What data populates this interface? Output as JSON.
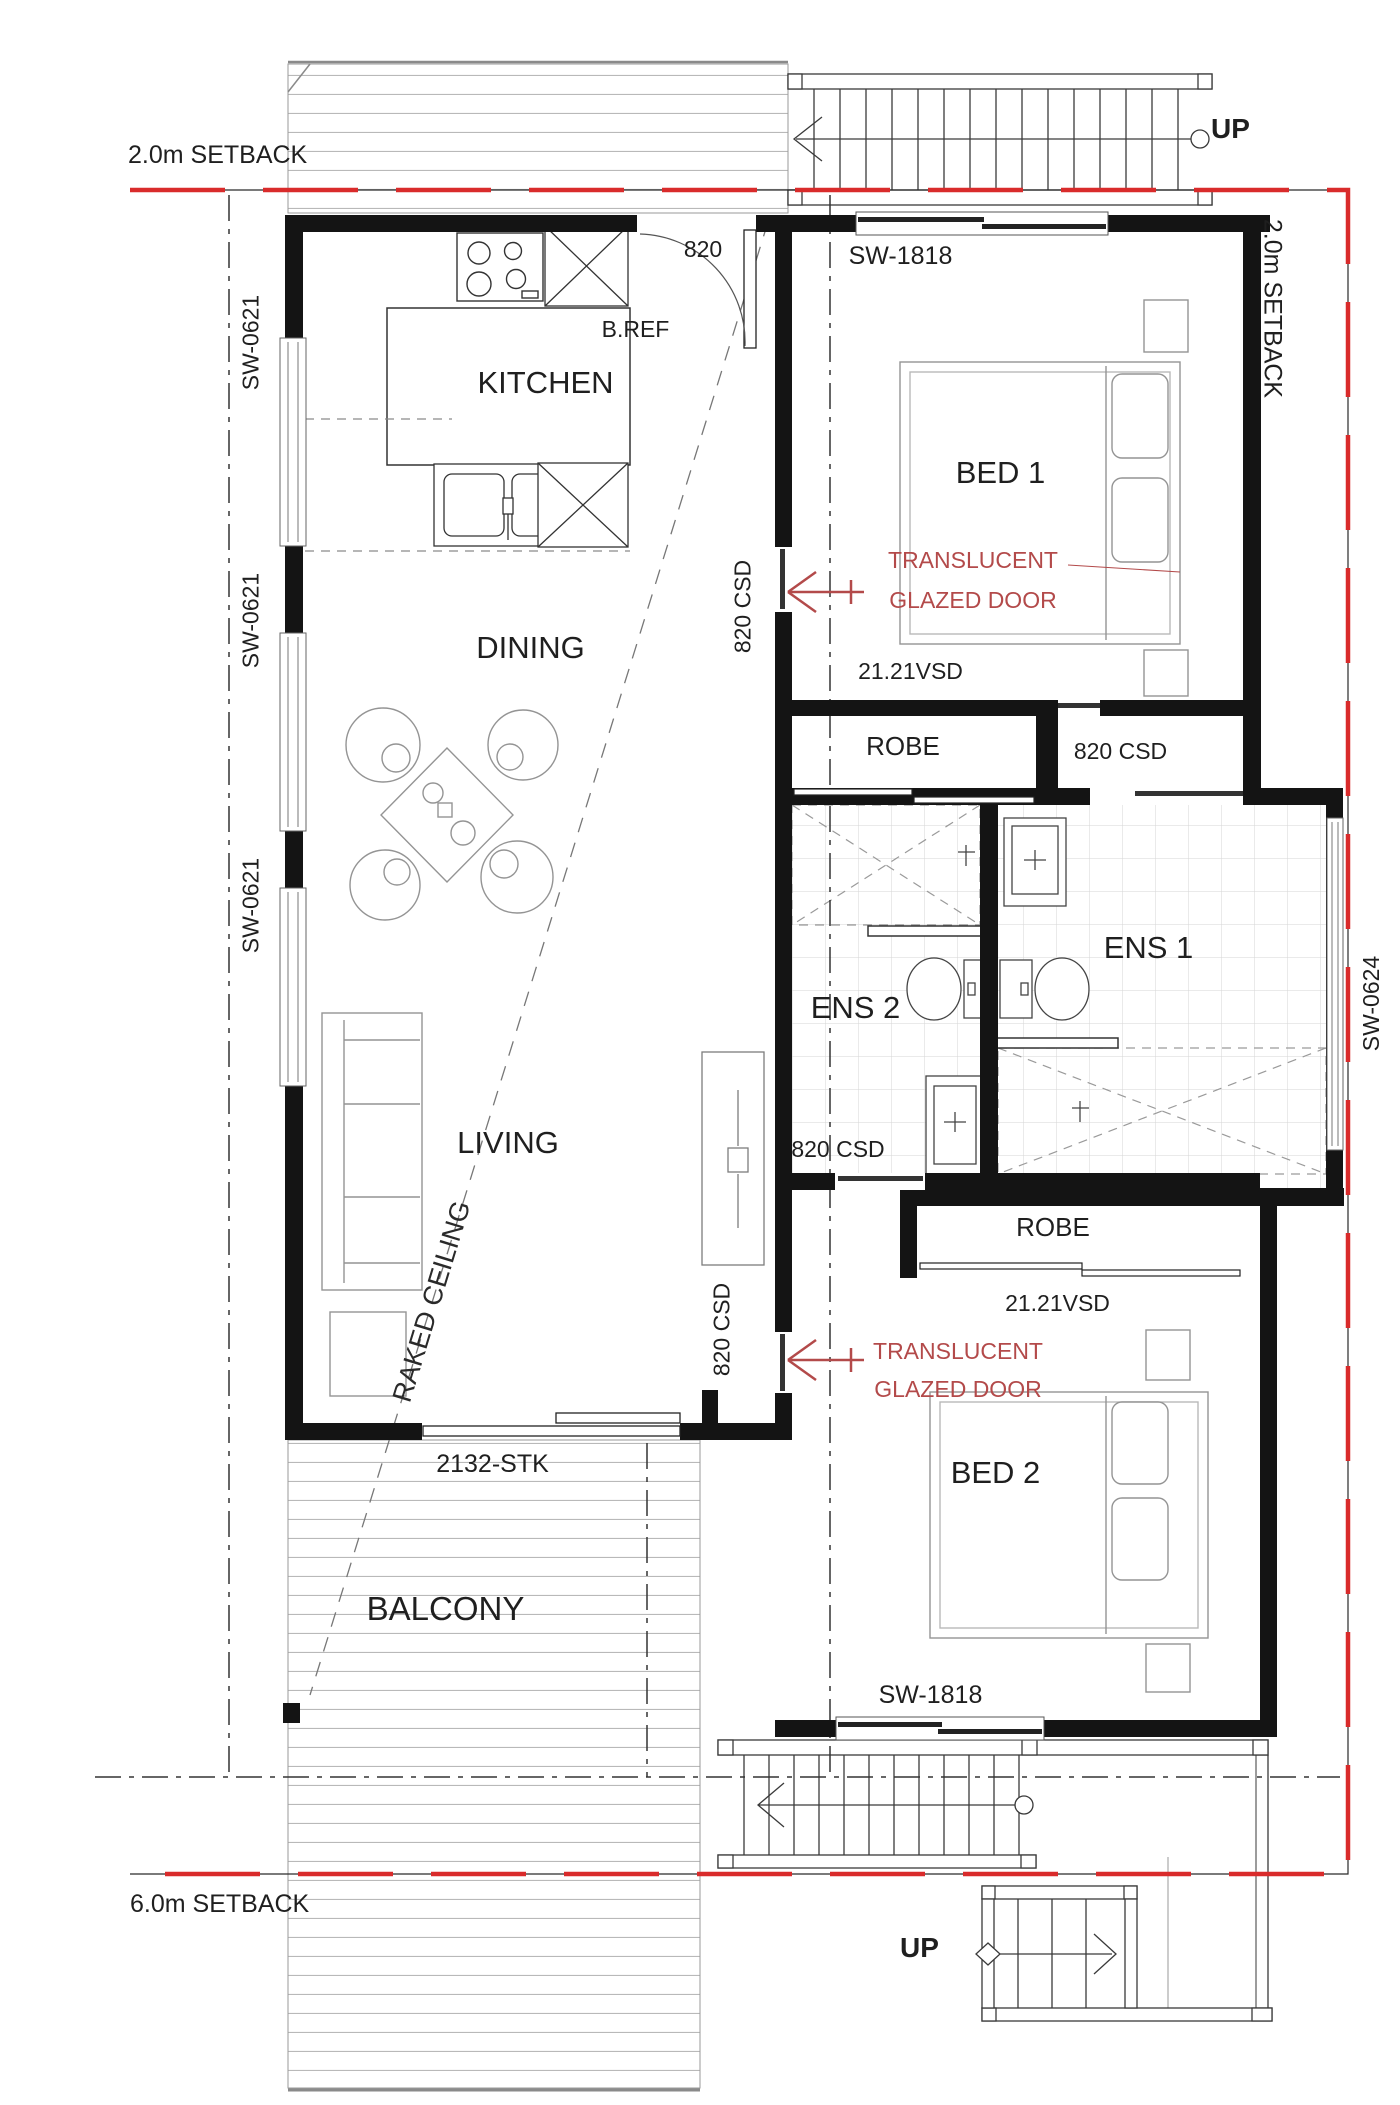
{
  "plan": {
    "setbacks": {
      "top": "2.0m SETBACK",
      "right": "2.0m SETBACK",
      "bottom": "6.0m SETBACK"
    },
    "rooms": {
      "kitchen": "KITCHEN",
      "dining": "DINING",
      "living": "LIVING",
      "balcony": "BALCONY",
      "bed1": "BED 1",
      "bed2": "BED 2",
      "ens1": "ENS 1",
      "ens2": "ENS 2",
      "robe": "ROBE"
    },
    "openings": {
      "entry_door": "820",
      "sliding_window_1818": "SW-1818",
      "sliding_window_0621": "SW-0621",
      "sliding_window_0624": "SW-0624",
      "cavity_slider": "820 CSD",
      "vertical_slider": "21.21VSD",
      "stacker_door": "2132-STK"
    },
    "appliances": {
      "fridge": "B.REF",
      "dishwasher": "DW"
    },
    "notes": {
      "raked_ceiling": "RAKED CEILING",
      "translucent_line1": "TRANSLUCENT",
      "translucent_line2": "GLAZED DOOR",
      "stairs_up": "UP"
    },
    "colors": {
      "setback_red": "#d92b2b",
      "annotation_red": "#b34a4a",
      "wall_black": "#141414"
    }
  }
}
